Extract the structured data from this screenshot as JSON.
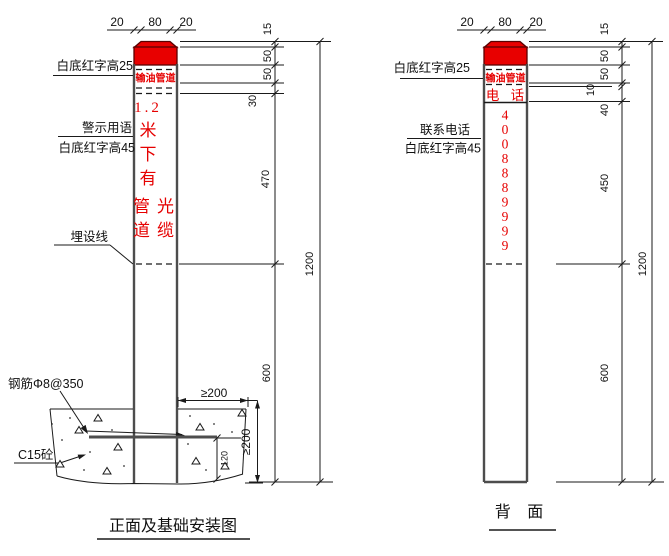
{
  "colors": {
    "marker_red": "#e60000",
    "cap_fill": "#e80000",
    "post_outline": "#4d4d4d",
    "line_black": "#1a1a1a"
  },
  "front_view": {
    "title": "正面及基础安装图",
    "top_dims": {
      "left": "20",
      "mid": "80",
      "right": "20"
    },
    "post": {
      "band_text": "输油管道",
      "warn_1": "1.2",
      "warn_2": "米",
      "warn_3": "下",
      "warn_4": "有",
      "warn_5a": "管",
      "warn_5b": "光",
      "warn_6a": "道",
      "warn_6b": "缆"
    },
    "labels": {
      "band": "白底红字高25",
      "warn_top": "警示用语",
      "warn_bottom": "白底红字高45",
      "burial": "埋设线",
      "rebar": "钢筋Φ8@350",
      "concrete": "C15砼"
    },
    "dims": {
      "d15": "15",
      "d50a": "50",
      "d50b": "50",
      "d30": "30",
      "d470": "470",
      "d600": "600",
      "d1200": "1200"
    },
    "foundation_dims": {
      "width_min": "≥200",
      "depth_min": "≥200",
      "step": "120"
    }
  },
  "back_view": {
    "title": "背  面",
    "top_dims": {
      "left": "20",
      "mid": "80",
      "right": "20"
    },
    "post": {
      "band_text": "输油管道",
      "phone_label": "电 话",
      "digits": [
        "4",
        "0",
        "0",
        "8",
        "8",
        "8",
        "9",
        "9",
        "9",
        "9"
      ]
    },
    "labels": {
      "band": "白底红字高25",
      "contact_top": "联系电话",
      "contact_bottom": "白底红字高45"
    },
    "dims": {
      "d15": "15",
      "d50a": "50",
      "d50b": "50",
      "d10": "10",
      "d40": "40",
      "d450": "450",
      "d600": "600",
      "d1200": "1200"
    }
  }
}
